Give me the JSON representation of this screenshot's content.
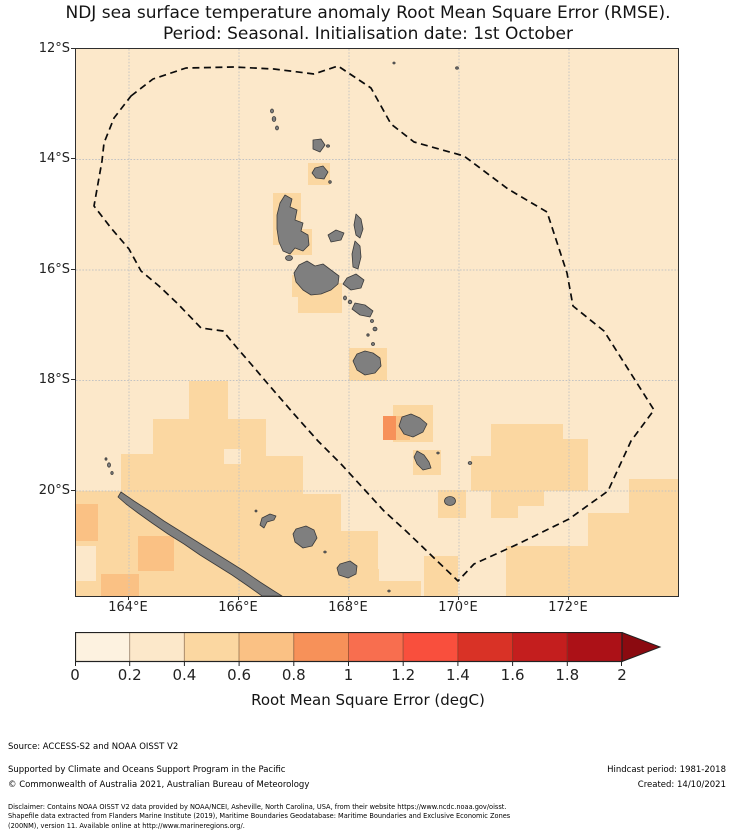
{
  "title": {
    "line1": "NDJ sea surface temperature anomaly Root Mean Square Error (RMSE).",
    "line2": "Period: Seasonal. Initialisation date: 1st October"
  },
  "map": {
    "lat_labels": [
      "12°S",
      "14°S",
      "16°S",
      "18°S",
      "20°S"
    ],
    "lon_labels": [
      "164°E",
      "166°E",
      "168°E",
      "170°E",
      "172°E"
    ],
    "ocean_color": "#fce8ca",
    "island_color": "#7f7f7f",
    "eez_boundary_style": "black dashed"
  },
  "colorbar": {
    "title": "Root Mean Square Error (degC)",
    "tick_labels": [
      "0",
      "0.2",
      "0.4",
      "0.6",
      "0.8",
      "1",
      "1.2",
      "1.4",
      "1.6",
      "1.8",
      "2"
    ],
    "segment_colors": [
      "#fdf2e0",
      "#fce8ca",
      "#fbd7a1",
      "#fac184",
      "#f79159",
      "#f86e4f",
      "#f94f3d",
      "#d93226",
      "#c41e1e",
      "#ac1117"
    ],
    "extend_color": "#8b0a10"
  },
  "footer": {
    "source": "Source: ACCESS-S2 and NOAA OISST V2",
    "supported": "Supported by Climate and Oceans Support Program in the Pacific",
    "copyright": "© Commonwealth of Australia 2021, Australian Bureau of Meteorology",
    "hindcast": "Hindcast period: 1981-2018",
    "created": "Created: 14/10/2021",
    "disclaimer_line1": "Disclaimer: Contains NOAA OISST V2 data provided by NOAA/NCEI, Asheville, North Carolina, USA, from their website https://www.ncdc.noaa.gov/oisst.",
    "disclaimer_line2": "Shapefile data extracted from Flanders Marine Institute (2019), Maritime Boundaries Geodatabase: Maritime Boundaries and Exclusive Economic Zones",
    "disclaimer_line3": "(200NM), version 11. Available online at http://www.marineregions.org/."
  },
  "chart_data": {
    "type": "map",
    "title": "NDJ sea surface temperature anomaly Root Mean Square Error (RMSE). Period: Seasonal. Initialisation date: 1st October",
    "colorbar_label": "Root Mean Square Error (degC)",
    "colorbar_ticks": [
      0,
      0.2,
      0.4,
      0.6,
      0.8,
      1,
      1.2,
      1.4,
      1.6,
      1.8,
      2
    ],
    "colorbar_range": [
      0,
      2
    ],
    "colorbar_extend": "max",
    "lon_ticks": [
      "164°E",
      "166°E",
      "168°E",
      "170°E",
      "172°E"
    ],
    "lat_ticks": [
      "12°S",
      "14°S",
      "16°S",
      "18°S",
      "20°S"
    ],
    "legend_position": "bottom",
    "notes": "Most ocean in 0.2-0.4 band; 0.4-0.8 patches around Vanuatu islands, southwest near New Caledonia and southeast of Tanna"
  }
}
